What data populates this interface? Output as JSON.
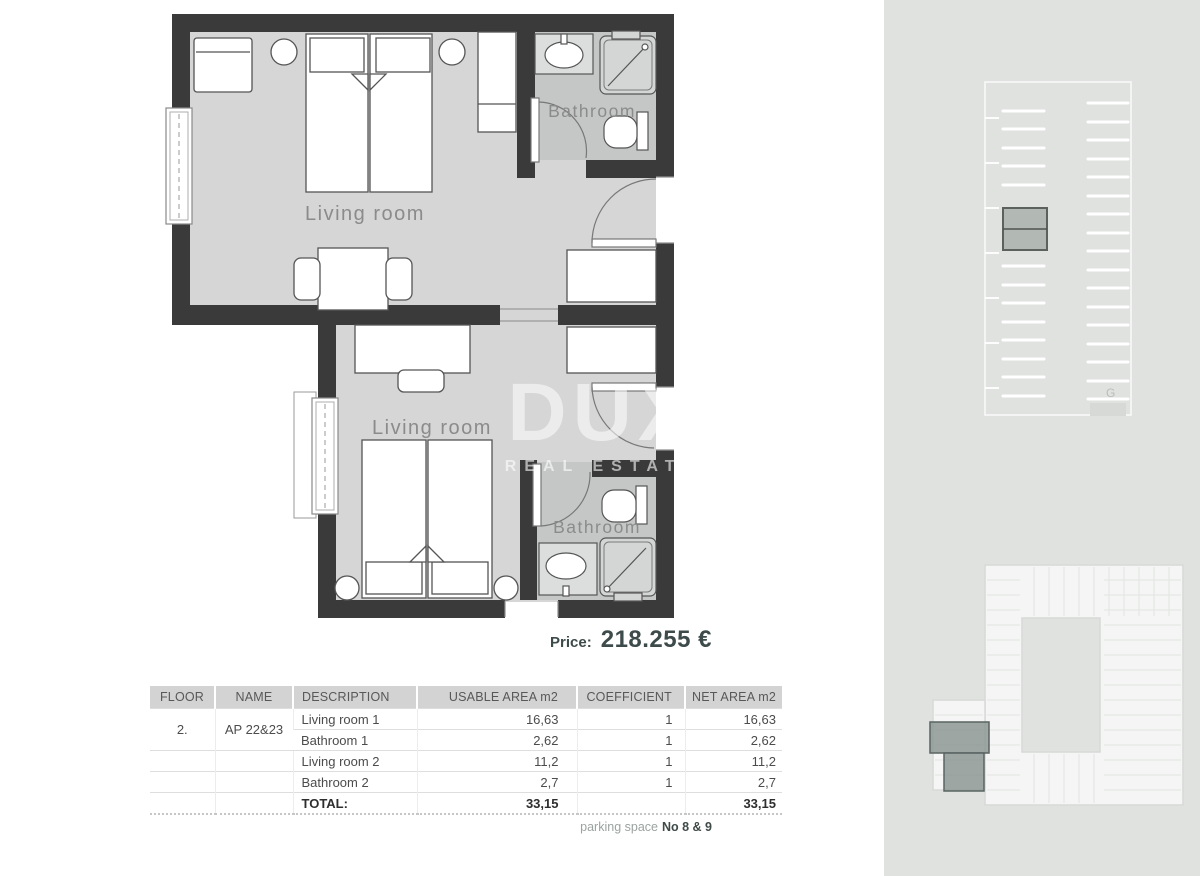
{
  "floorplan": {
    "labels": {
      "living_room_1": "Living room",
      "bathroom_1": "Bathroom",
      "living_room_2": "Living room",
      "bathroom_2": "Bathroom"
    }
  },
  "watermark": {
    "brand": "DUX",
    "subtitle": "REAL ESTATE"
  },
  "price": {
    "label": "Price:",
    "value": "218.255 €"
  },
  "area_table": {
    "headers": [
      "FLOOR",
      "NAME",
      "DESCRIPTION",
      "USABLE AREA m2",
      "COEFFICIENT",
      "NET AREA m2"
    ],
    "rows": [
      {
        "floor": "2.",
        "name": "AP 22&23",
        "description": "Living room 1",
        "usable": "16,63",
        "coefficient": "1",
        "net": "16,63"
      },
      {
        "description": "Bathroom 1",
        "usable": "2,62",
        "coefficient": "1",
        "net": "2,62"
      },
      {
        "description": "Living room 2",
        "usable": "11,2",
        "coefficient": "1",
        "net": "11,2"
      },
      {
        "description": "Bathroom 2",
        "usable": "2,7",
        "coefficient": "1",
        "net": "2,7"
      }
    ],
    "total": {
      "label": "TOTAL:",
      "usable": "33,15",
      "net": "33,15"
    }
  },
  "footer": {
    "parking_label": "parking space",
    "parking_value": "No 8 & 9"
  },
  "sidebar": {
    "garage_label": "G"
  },
  "colors": {
    "wall": "#3a3a3a",
    "floor": "#d5d6d5",
    "bathroom_floor": "#c5c7c7",
    "sidebar_bg": "#e0e2e0",
    "parking_highlight": "#b2b9b5",
    "apartment_highlight": "#8d9894",
    "price_text": "#3e4b4b"
  }
}
